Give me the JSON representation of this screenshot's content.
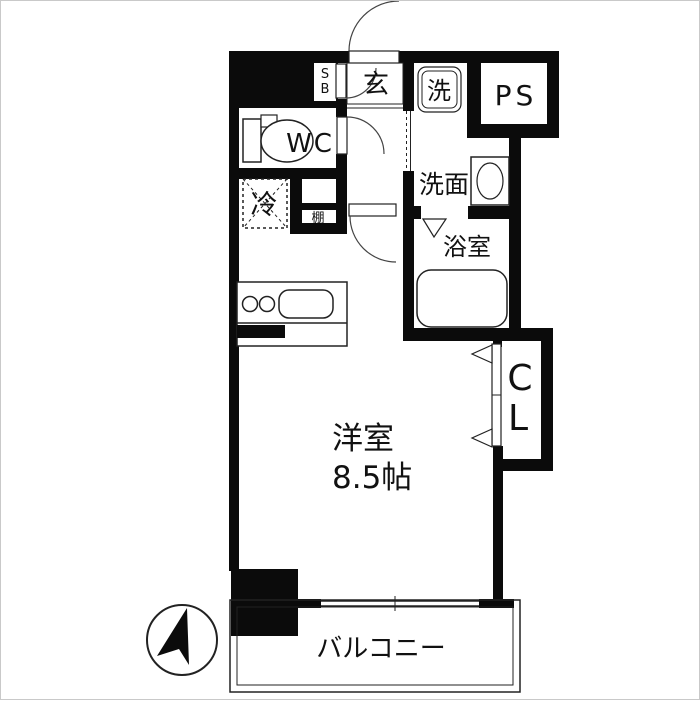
{
  "plan": {
    "labels": {
      "entrance": "玄",
      "shoe_box": {
        "line1": "S",
        "line2": "B"
      },
      "washer": "洗",
      "pipe_space": "PS",
      "toilet_room": "WC",
      "refrigerator": "冷",
      "shelf": "棚",
      "washroom": "洗面",
      "bathroom": "浴室",
      "closet": {
        "line1": "C",
        "line2": "L"
      },
      "main_room": {
        "name": "洋室",
        "size": "8.5帖"
      },
      "balcony": "バルコニー"
    },
    "colors": {
      "wall": "#0b0b0b",
      "line": "#222222",
      "background": "#ffffff",
      "border": "#c9c9c9"
    }
  }
}
